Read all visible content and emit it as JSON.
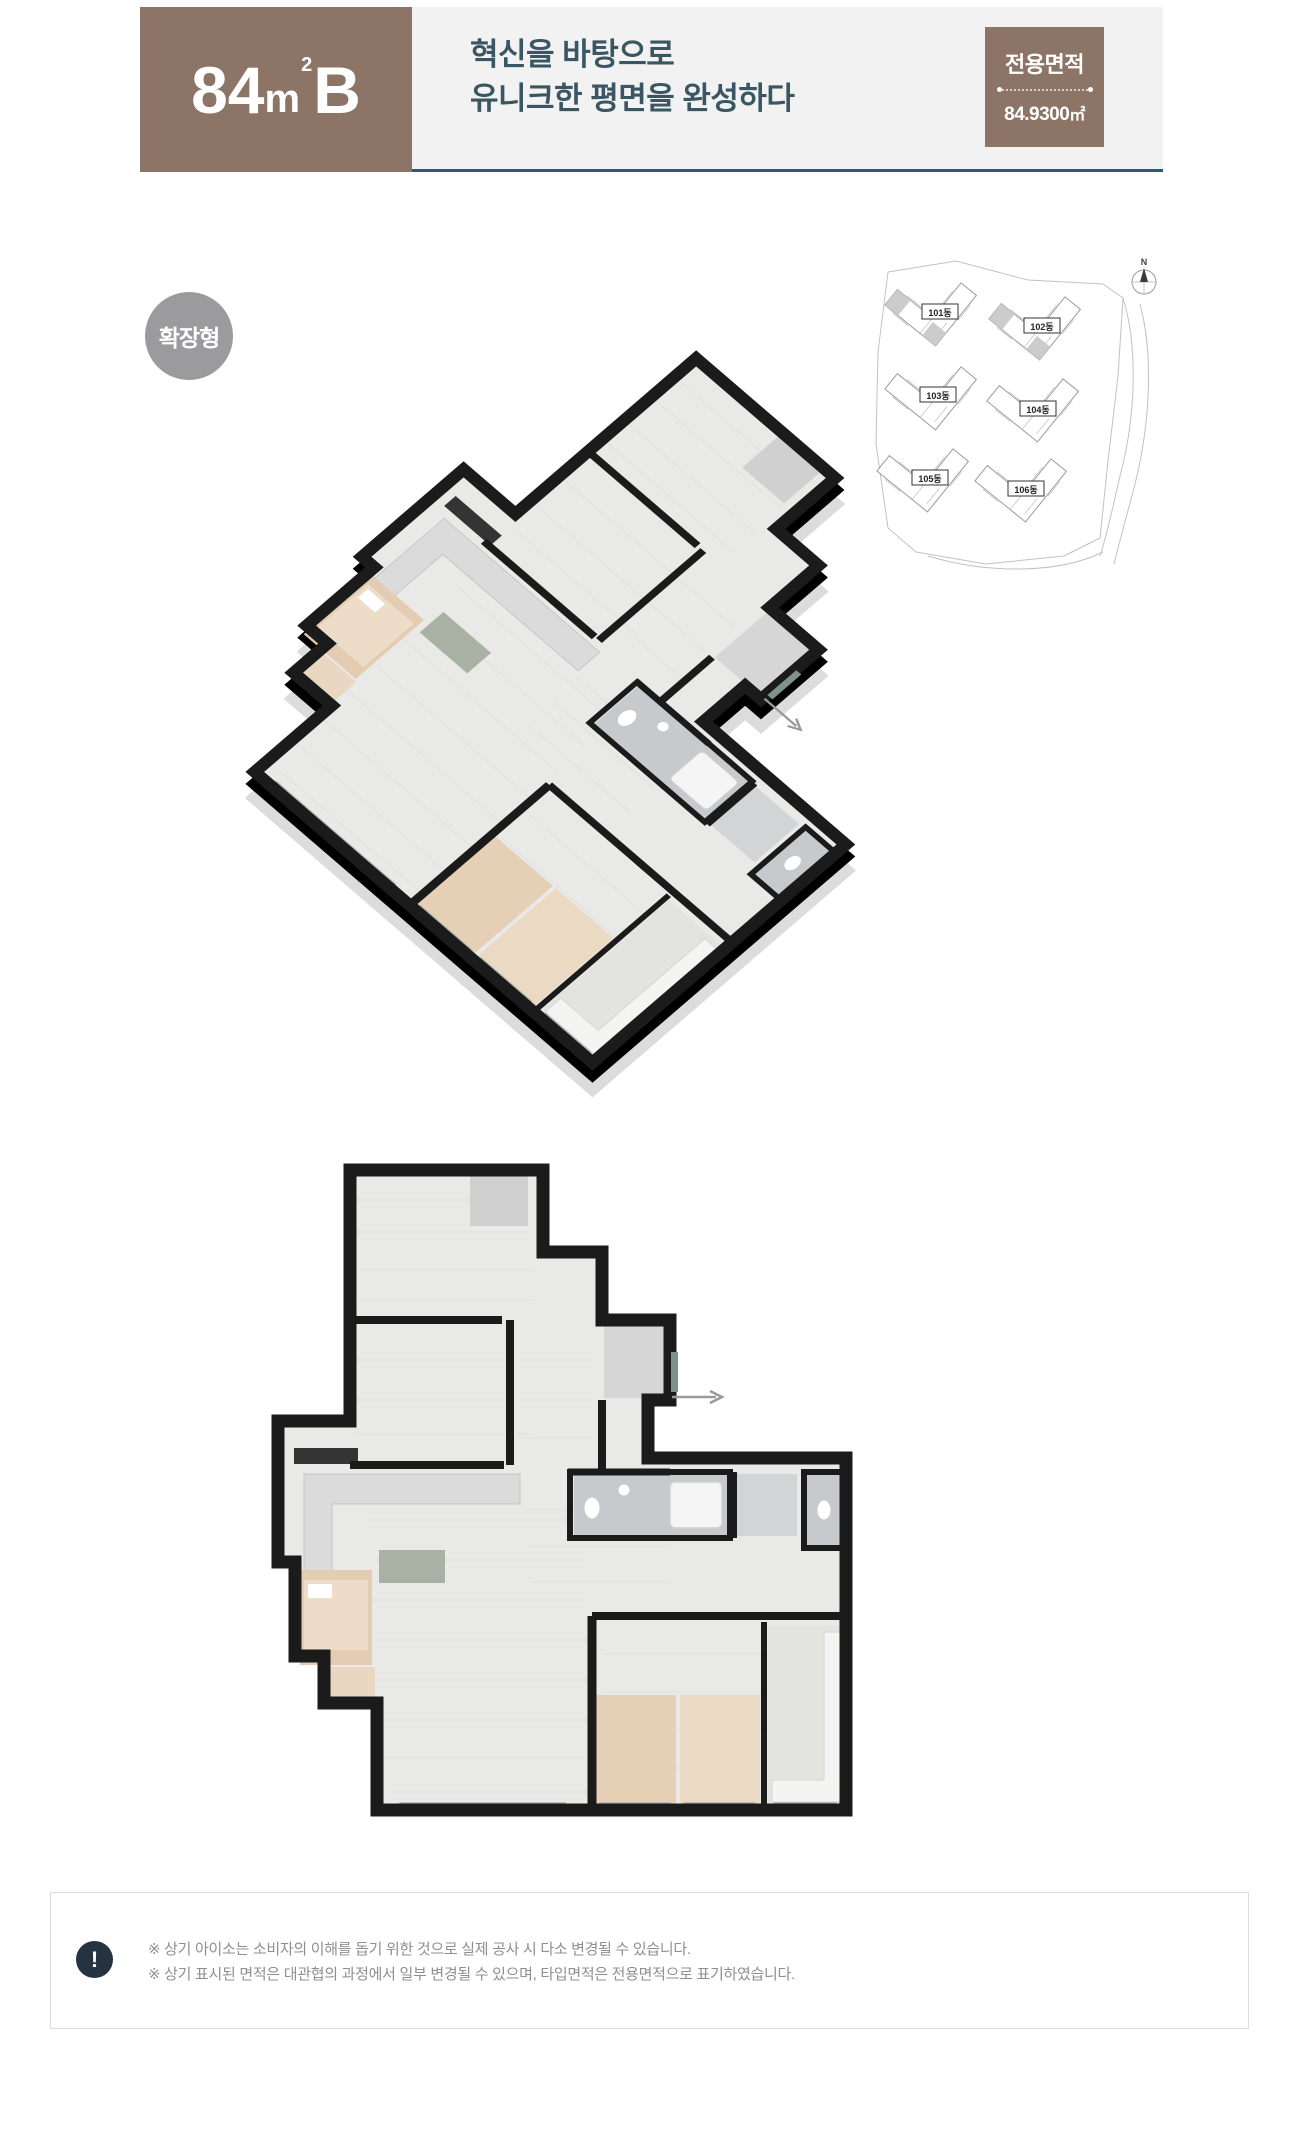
{
  "header": {
    "type_badge": {
      "number": "84",
      "unit": "m",
      "superscript": "2",
      "suffix": "B"
    },
    "title_line1": "혁신을 바탕으로",
    "title_line2": "유니크한 평면을 완성하다",
    "area_box": {
      "label": "전용면적",
      "value": "84.9300",
      "unit": "㎡"
    },
    "colors": {
      "brown": "#8c7467",
      "rule": "#2f5b6a",
      "title_text": "#3a5662",
      "strip_bg": "#f2f2f2"
    }
  },
  "plan_type_badge": {
    "label": "확장형",
    "color": "#9b9b9d"
  },
  "site_map": {
    "compass_label": "N",
    "buildings": [
      {
        "label": "101동"
      },
      {
        "label": "102동"
      },
      {
        "label": "103동"
      },
      {
        "label": "104동"
      },
      {
        "label": "105동"
      },
      {
        "label": "106동"
      }
    ]
  },
  "footer": {
    "icon_glyph": "!",
    "notes": [
      "※ 상기 아이소는 소비자의 이해를 돕기 위한 것으로 실제 공사 시 다소 변경될 수 있습니다.",
      "※ 상기 표시된 면적은 대관협의 과정에서 일부 변경될 수 있으며, 타입면적은 전용면적으로 표기하였습니다."
    ]
  }
}
